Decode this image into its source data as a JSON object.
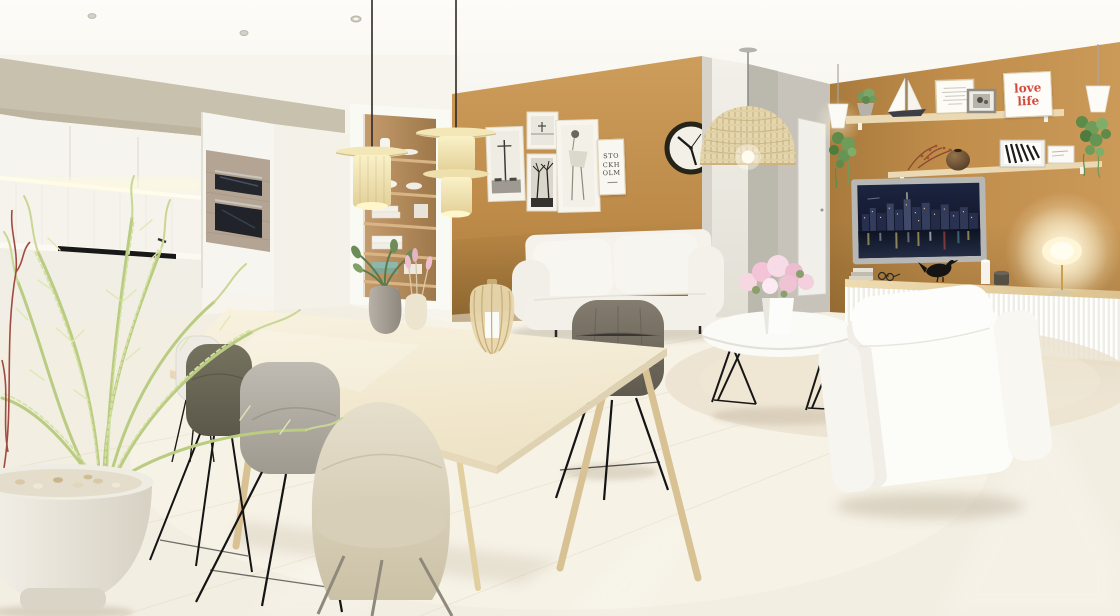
{
  "scene": {
    "description": "Sunlit open-plan apartment 3D render with white kitchen, dining set and living area against ochre feature walls",
    "rooms": [
      "kitchen",
      "dining area",
      "living area",
      "hallway"
    ]
  },
  "art": {
    "stockholm_poster": {
      "line1": "STO",
      "line2": "CKH",
      "line3": "OLM"
    },
    "love_life_poster": {
      "line1": "love",
      "line2": "life"
    }
  },
  "gallery_wall_frames": [
    "street-lamp-photo",
    "seaside-cross-photo",
    "palm-trees-photo",
    "fashion-sketch",
    "stockholm-typography-poster"
  ],
  "shelf_decor": [
    "potted-plant",
    "model-sailboat",
    "framed-quote-print",
    "small-photo-frame",
    "love-life-print",
    "berry-branch",
    "round-ceramic-vase",
    "zebra-photo",
    "small-art-card",
    "hanging-pothos",
    "white-cone-pendant"
  ],
  "tv_screen_content": "night city skyline with lit towers reflected in water",
  "furniture": [
    "white-kitchen-cabinets",
    "built-in-oven",
    "linen-closet",
    "dining-table",
    "dining-chairs",
    "cream-pendant-lamps",
    "rattan-dome-pendant",
    "white-sofa",
    "round-coffee-table",
    "pink-flower-vase",
    "white-armchair",
    "floating-sideboard",
    "glowing-table-lamp",
    "wall-clock",
    "area-rug",
    "floor-plant-in-white-pot"
  ],
  "palette": {
    "ochre_wall": "#bf8c4a",
    "ceiling_white": "#fbfaf5",
    "floor_cream": "#f2ecdf",
    "kitchen_soffit": "#c8c1ad",
    "shelf_wood": "#ead9b2",
    "love_life_red": "#d64a3e",
    "lamp_glow": "#fff6d8",
    "plant_green": "#c9d694"
  }
}
